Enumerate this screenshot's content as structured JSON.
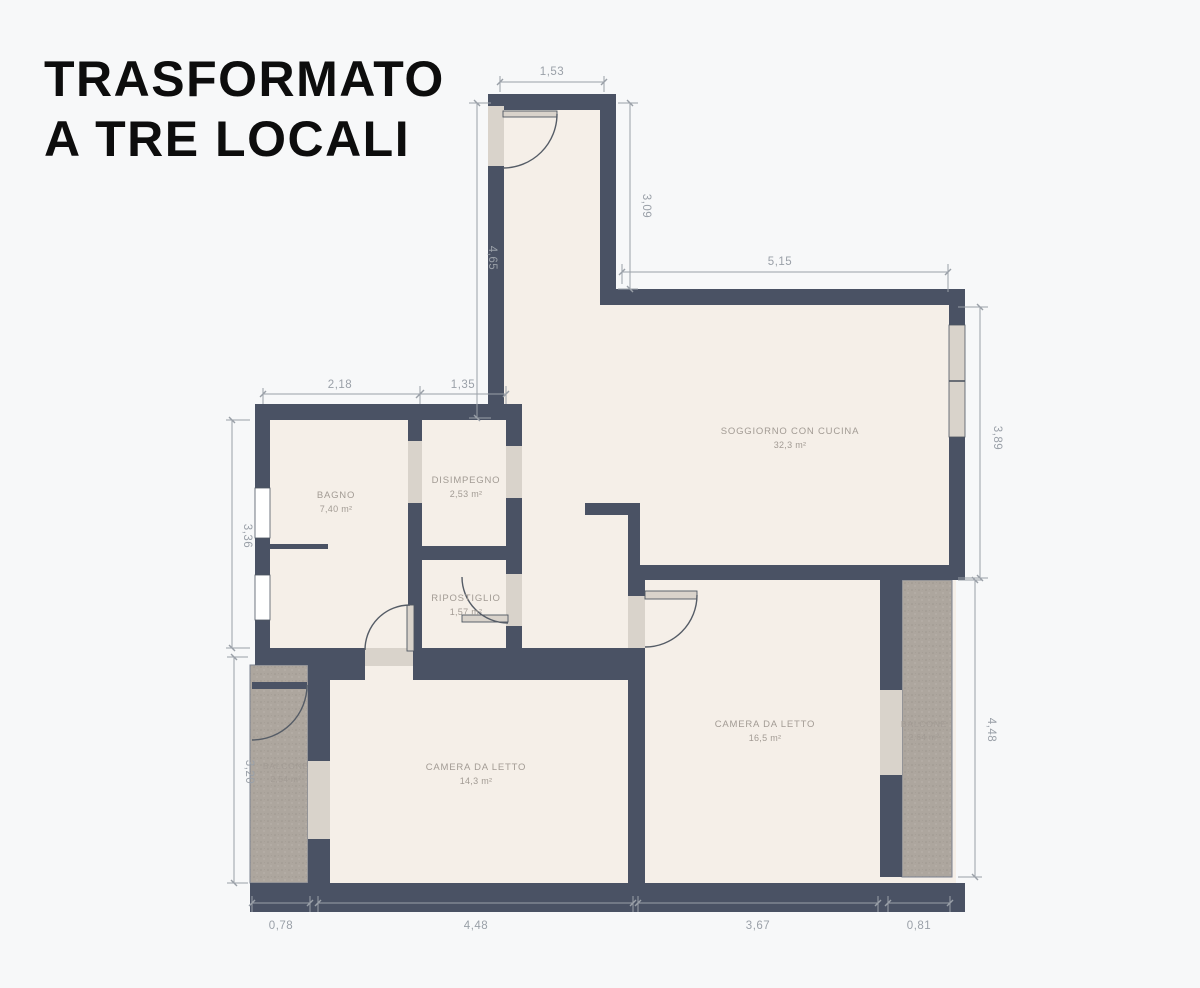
{
  "title": {
    "line1": "TRASFORMATO",
    "line2": "A TRE LOCALI"
  },
  "rooms": {
    "bagno": {
      "name": "BAGNO",
      "area": "7,40 m²"
    },
    "disimpegno": {
      "name": "DISIMPEGNO",
      "area": "2,53 m²"
    },
    "ripostiglio": {
      "name": "RIPOSTIGLIO",
      "area": "1,57 m²"
    },
    "soggiorno": {
      "name": "SOGGIORNO CON CUCINA",
      "area": "32,3 m²"
    },
    "camera_grande": {
      "name": "CAMERA DA LETTO",
      "area": "16,5 m²"
    },
    "camera_piccola": {
      "name": "CAMERA DA LETTO",
      "area": "14,3 m²"
    },
    "balcone_sinistro": {
      "name": "BALCONE",
      "area": "2,54 m²"
    },
    "balcone_destro": {
      "name": "BALCONE",
      "area": "2,64 m²"
    }
  },
  "dimensions": {
    "ingresso_larghezza": "1,53",
    "ingresso_lato_destro": "3,09",
    "soggiorno_larghezza": "5,15",
    "corridoio_altezza": "4,65",
    "bagno_larghezza": "2,18",
    "disimpegno_larghezza": "1,35",
    "soggiorno_altezza": "3,89",
    "bagno_altezza": "3,36",
    "balcone_sinistro_altezza": "3,20",
    "balcone_destro_altezza": "4,48",
    "basso_balcone_sinistro": "0,78",
    "basso_camera_piccola": "4,48",
    "basso_camera_grande": "3,67",
    "basso_balcone_destro": "0,81"
  },
  "colors": {
    "wall": "#4a5264",
    "floor": "#f5efe8",
    "background": "#f7f8f9",
    "balcony": "#ada69e",
    "opening": "#d9d3cb",
    "dimension": "#9aa0a8",
    "room_label": "#a29b94",
    "title": "#0d0d0d"
  }
}
